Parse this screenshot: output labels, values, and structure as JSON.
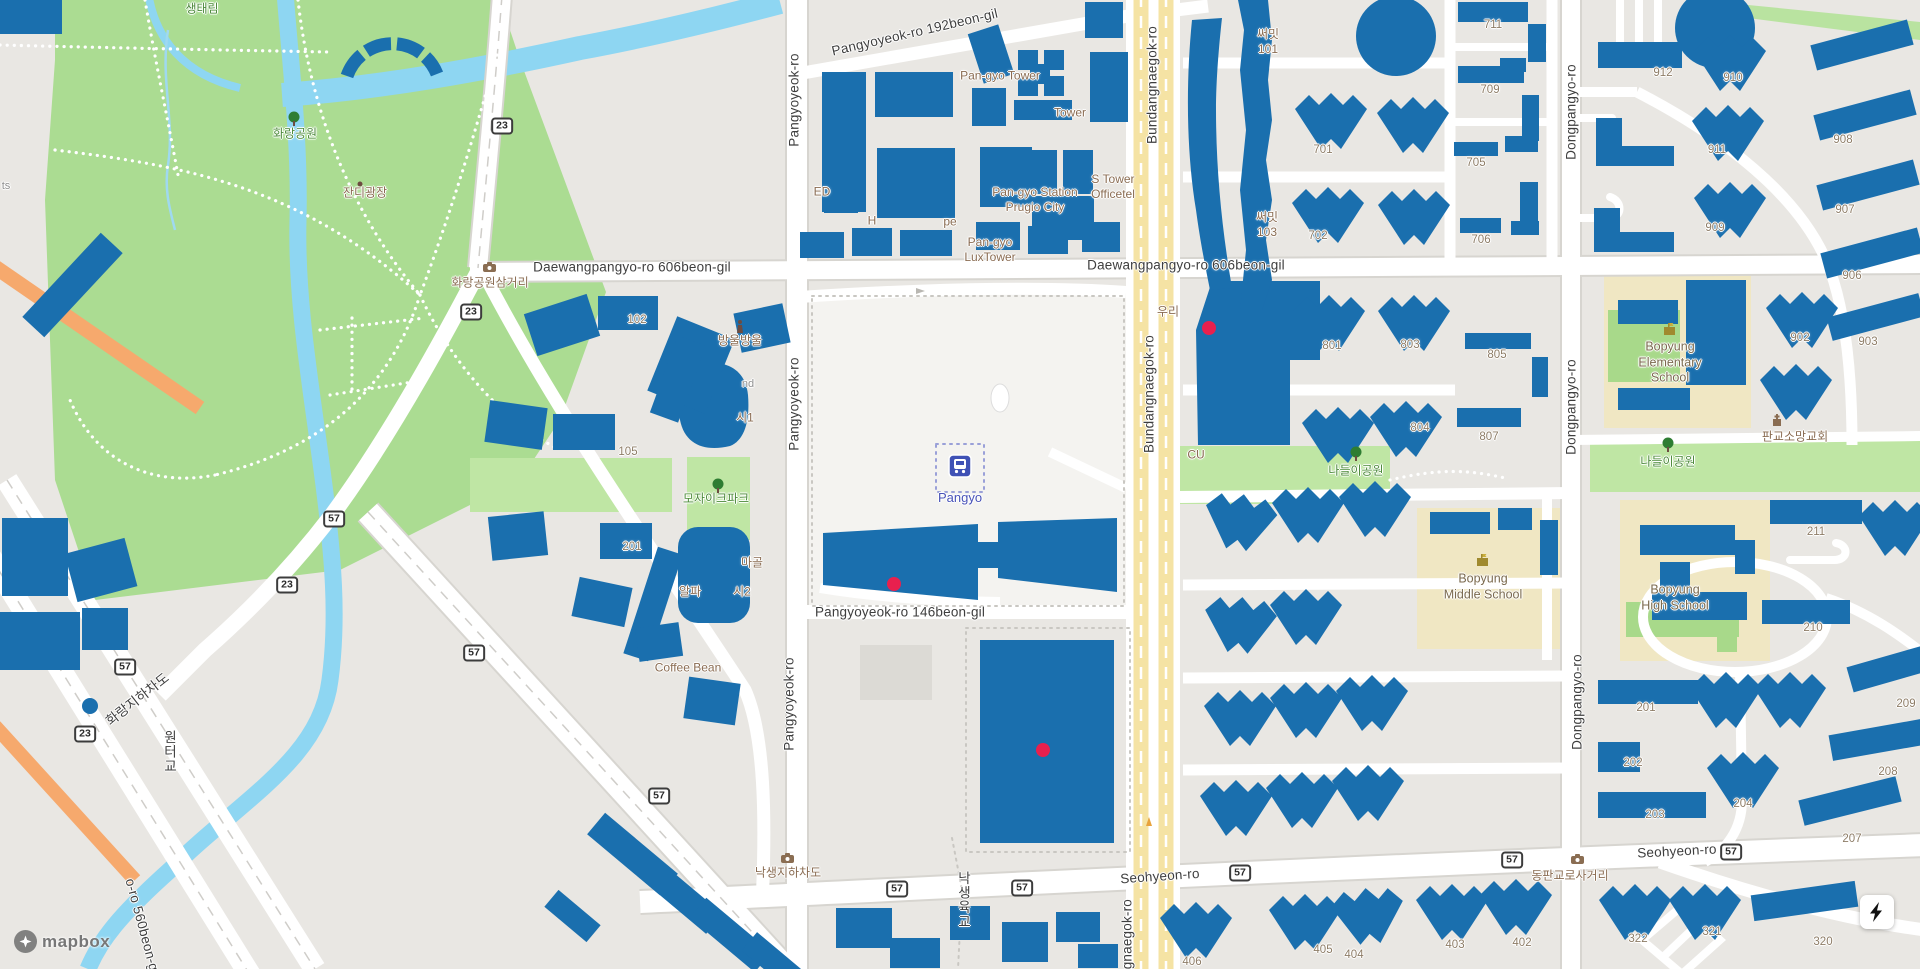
{
  "map": {
    "attribution": "mapbox",
    "station": {
      "name": "Pangyo",
      "x": 960,
      "y": 498,
      "icon_x": 960,
      "icon_y": 466
    },
    "controls": {
      "lightning_button": "lightning-bolt"
    },
    "colors": {
      "building": "#1a6fae",
      "marker": "#e8204e",
      "park_green": "#abdc92",
      "light_green": "#bfe6a4",
      "water": "#8ed6f2",
      "road_yellow": "#f5e3a4",
      "school_area": "#f0e7c3",
      "orange_road": "#f6a96d",
      "station_label": "#4953b8"
    }
  },
  "labels": {
    "streets": [
      {
        "text": "Pangyoyeok-ro",
        "x": 795,
        "y": 100,
        "rot": -90
      },
      {
        "text": "Pangyoyeok-ro",
        "x": 795,
        "y": 404,
        "rot": -90
      },
      {
        "text": "Pangyoyeok-ro",
        "x": 790,
        "y": 704,
        "rot": -90
      },
      {
        "text": "Bundangnaegok-ro",
        "x": 1153,
        "y": 85,
        "rot": -90
      },
      {
        "text": "Bundangnaegok-ro",
        "x": 1150,
        "y": 394,
        "rot": -90
      },
      {
        "text": "Bundangnaegok-ro",
        "x": 1128,
        "y": 958,
        "rot": -90
      },
      {
        "text": "Dongpangyo-ro",
        "x": 1572,
        "y": 112,
        "rot": -90
      },
      {
        "text": "Dongpangyo-ro",
        "x": 1572,
        "y": 407,
        "rot": -90
      },
      {
        "text": "Dongpangyo-ro",
        "x": 1578,
        "y": 702,
        "rot": -90
      },
      {
        "text": "Daewangpangyo-ro 606beon-gil",
        "x": 632,
        "y": 268,
        "rot": 0
      },
      {
        "text": "Daewangpangyo-ro 606beon-gil",
        "x": 1186,
        "y": 266,
        "rot": 0
      },
      {
        "text": "Pangyoyeok-ro 192beon-gil",
        "x": 915,
        "y": 33,
        "rot": -13
      },
      {
        "text": "Pangyoyeok-ro 146beon-gil",
        "x": 900,
        "y": 613,
        "rot": 0
      },
      {
        "text": "Seohyeon-ro",
        "x": 1160,
        "y": 877,
        "rot": -4
      },
      {
        "text": "Seohyeon-ro",
        "x": 1677,
        "y": 852,
        "rot": -3
      },
      {
        "text": "화랑지하차도",
        "x": 138,
        "y": 700,
        "rot": -38
      },
      {
        "text": "o-ro 560beon-gil",
        "x": 142,
        "y": 928,
        "rot": 75
      },
      {
        "text": "원터교",
        "x": 168,
        "y": 752,
        "v": 1
      },
      {
        "text": "낙생육교",
        "x": 962,
        "y": 900,
        "v": 1
      }
    ],
    "shields": [
      {
        "n": "23",
        "x": 502,
        "y": 126
      },
      {
        "n": "23",
        "x": 471,
        "y": 312
      },
      {
        "n": "23",
        "x": 287,
        "y": 585
      },
      {
        "n": "23",
        "x": 85,
        "y": 734
      },
      {
        "n": "57",
        "x": 334,
        "y": 519
      },
      {
        "n": "57",
        "x": 125,
        "y": 667
      },
      {
        "n": "57",
        "x": 474,
        "y": 653
      },
      {
        "n": "57",
        "x": 659,
        "y": 796
      },
      {
        "n": "57",
        "x": 897,
        "y": 889
      },
      {
        "n": "57",
        "x": 1022,
        "y": 888
      },
      {
        "n": "57",
        "x": 1240,
        "y": 873
      },
      {
        "n": "57",
        "x": 1512,
        "y": 860
      },
      {
        "n": "57",
        "x": 1731,
        "y": 852
      }
    ],
    "building_numbers": [
      {
        "text": "102",
        "x": 637,
        "y": 320
      },
      {
        "text": "105",
        "x": 628,
        "y": 452
      },
      {
        "text": "201",
        "x": 632,
        "y": 547
      },
      {
        "text": "701",
        "x": 1323,
        "y": 150
      },
      {
        "text": "702",
        "x": 1318,
        "y": 236
      },
      {
        "text": "801",
        "x": 1332,
        "y": 346
      },
      {
        "text": "803",
        "x": 1410,
        "y": 345
      },
      {
        "text": "804",
        "x": 1420,
        "y": 428
      },
      {
        "text": "711",
        "x": 1493,
        "y": 25
      },
      {
        "text": "709",
        "x": 1490,
        "y": 90
      },
      {
        "text": "705",
        "x": 1476,
        "y": 163
      },
      {
        "text": "706",
        "x": 1481,
        "y": 240
      },
      {
        "text": "805",
        "x": 1497,
        "y": 355
      },
      {
        "text": "807",
        "x": 1489,
        "y": 437
      },
      {
        "text": "912",
        "x": 1663,
        "y": 73
      },
      {
        "text": "910",
        "x": 1733,
        "y": 78
      },
      {
        "text": "911",
        "x": 1717,
        "y": 150
      },
      {
        "text": "909",
        "x": 1715,
        "y": 228
      },
      {
        "text": "908",
        "x": 1843,
        "y": 140
      },
      {
        "text": "907",
        "x": 1845,
        "y": 210
      },
      {
        "text": "906",
        "x": 1852,
        "y": 276
      },
      {
        "text": "902",
        "x": 1800,
        "y": 338
      },
      {
        "text": "903",
        "x": 1868,
        "y": 342
      },
      {
        "text": "211",
        "x": 1816,
        "y": 532
      },
      {
        "text": "210",
        "x": 1813,
        "y": 628
      },
      {
        "text": "209",
        "x": 1906,
        "y": 704
      },
      {
        "text": "208",
        "x": 1888,
        "y": 772
      },
      {
        "text": "207",
        "x": 1852,
        "y": 839
      },
      {
        "text": "201",
        "x": 1646,
        "y": 708
      },
      {
        "text": "202",
        "x": 1633,
        "y": 763
      },
      {
        "text": "203",
        "x": 1655,
        "y": 815
      },
      {
        "text": "204",
        "x": 1743,
        "y": 804
      },
      {
        "text": "322",
        "x": 1638,
        "y": 939
      },
      {
        "text": "321",
        "x": 1712,
        "y": 932
      },
      {
        "text": "320",
        "x": 1823,
        "y": 942
      },
      {
        "text": "406",
        "x": 1192,
        "y": 962
      },
      {
        "text": "405",
        "x": 1323,
        "y": 950
      },
      {
        "text": "404",
        "x": 1354,
        "y": 955
      },
      {
        "text": "403",
        "x": 1455,
        "y": 945
      },
      {
        "text": "402",
        "x": 1522,
        "y": 943
      }
    ],
    "pois": [
      {
        "text": "화랑공원삼거리",
        "x": 490,
        "y": 283
      },
      {
        "text": "낙생지하차도",
        "x": 788,
        "y": 873
      },
      {
        "text": "동판교로사거리",
        "x": 1570,
        "y": 876
      },
      {
        "text": "방울방울",
        "x": 740,
        "y": 341
      },
      {
        "text": "마골",
        "x": 752,
        "y": 563
      },
      {
        "text": "알파",
        "x": 690,
        "y": 592
      },
      {
        "text": "시2",
        "x": 742,
        "y": 592
      },
      {
        "text": "시1",
        "x": 745,
        "y": 418
      },
      {
        "text": "ED",
        "x": 822,
        "y": 192
      },
      {
        "text": "H",
        "x": 872,
        "y": 221
      },
      {
        "text": "pe",
        "x": 950,
        "y": 222
      },
      {
        "text": "Coffee Bean",
        "x": 688,
        "y": 668
      },
      {
        "text": "CU",
        "x": 1196,
        "y": 455
      },
      {
        "text": "판교소망교회",
        "x": 1795,
        "y": 437
      },
      {
        "text": "우리",
        "x": 1168,
        "y": 312
      },
      {
        "text": "Pan-gyo Tower",
        "x": 1000,
        "y": 76
      },
      {
        "text": "Tower",
        "x": 1070,
        "y": 113
      },
      {
        "text": "S Tower\nOfficetel",
        "x": 1113,
        "y": 187
      },
      {
        "text": "Pan-gyo Station\nPrugio City",
        "x": 1035,
        "y": 200
      },
      {
        "text": "Pan-gyo\nLuxTower",
        "x": 990,
        "y": 250
      },
      {
        "text": "써밋\n101",
        "x": 1268,
        "y": 42
      },
      {
        "text": "써밋\n103",
        "x": 1267,
        "y": 225
      },
      {
        "text": "잔디광장",
        "x": 365,
        "y": 193
      }
    ],
    "parks": [
      {
        "text": "화랑공원",
        "x": 295,
        "y": 134
      },
      {
        "text": "모자이크파크",
        "x": 716,
        "y": 499
      },
      {
        "text": "나들이공원",
        "x": 1356,
        "y": 471
      },
      {
        "text": "나들이공원",
        "x": 1668,
        "y": 462
      },
      {
        "text": "생태림",
        "x": 202,
        "y": 9
      }
    ],
    "schools": [
      {
        "text": "Bopyung\nMiddle School",
        "x": 1483,
        "y": 587
      },
      {
        "text": "Bopyung\nHigh School",
        "x": 1675,
        "y": 598
      },
      {
        "text": "Bopyung\nElementary\nSchool",
        "x": 1670,
        "y": 363
      }
    ],
    "fragments": [
      {
        "text": "ts",
        "x": 6,
        "y": 187
      },
      {
        "text": "nd",
        "x": 748,
        "y": 385
      }
    ]
  },
  "icons": [
    {
      "kind": "tree",
      "x": 294,
      "y": 118
    },
    {
      "kind": "tree",
      "x": 718,
      "y": 485
    },
    {
      "kind": "tree",
      "x": 1356,
      "y": 453
    },
    {
      "kind": "tree",
      "x": 1668,
      "y": 444
    },
    {
      "kind": "camera",
      "x": 490,
      "y": 266
    },
    {
      "kind": "camera",
      "x": 788,
      "y": 857
    },
    {
      "kind": "camera",
      "x": 1578,
      "y": 858
    },
    {
      "kind": "statue",
      "x": 743,
      "y": 327
    },
    {
      "kind": "church",
      "x": 1778,
      "y": 420
    },
    {
      "kind": "school",
      "x": 1483,
      "y": 560
    },
    {
      "kind": "school",
      "x": 1670,
      "y": 329
    },
    {
      "kind": "dot",
      "x": 364,
      "y": 181
    }
  ],
  "markers": [
    {
      "x": 1209,
      "y": 328
    },
    {
      "x": 894,
      "y": 584
    },
    {
      "x": 1043,
      "y": 750
    }
  ]
}
